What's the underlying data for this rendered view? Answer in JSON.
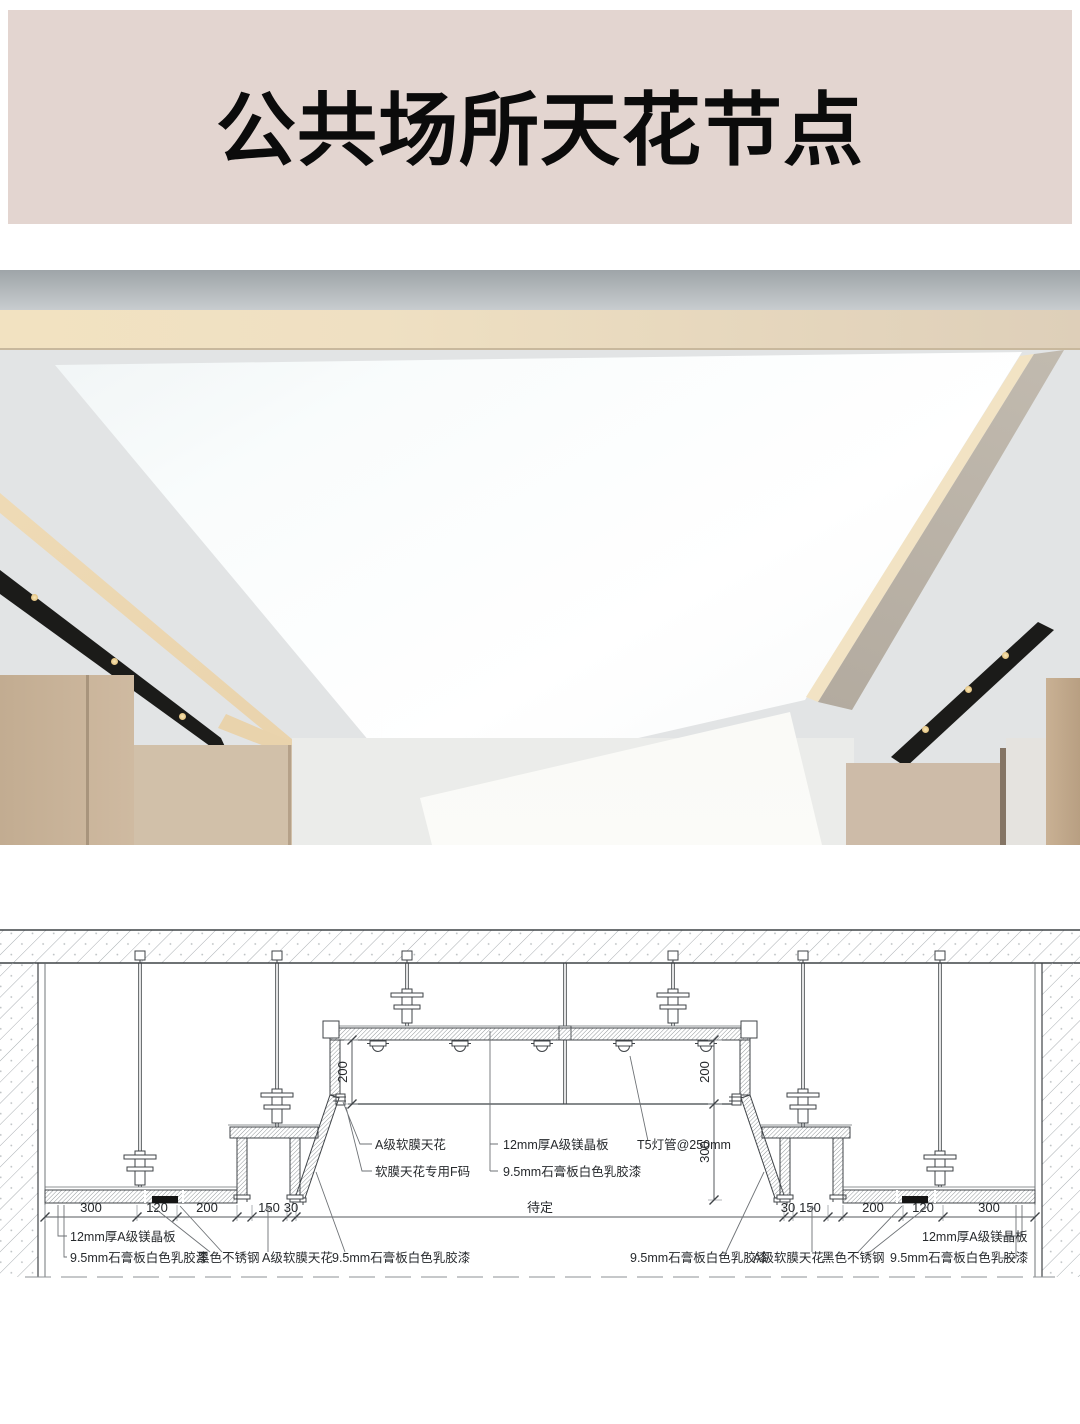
{
  "header": {
    "title": "公共场所天花节点",
    "bg_color": "#E3D5D0",
    "text_color": "#0B0B0B"
  },
  "photo": {
    "description_colors": {
      "fascia_gray": "#B9BEC2",
      "cove_warm_light": "#EFDEBD",
      "ceiling_white": "#E2E4E5",
      "luminous_panel": "#FAFCFC",
      "panel_edge": "#2E3032",
      "black_track": "#1B1B19",
      "track_glow": "#F3DCA8",
      "wood_wall": "#C8B299",
      "beige_wall": "#CDBBA8",
      "white_wall": "#EBECEA"
    }
  },
  "drawing": {
    "ink_color": "#3F4347",
    "dim_color": "#55595C",
    "bottom_dims": {
      "left": [
        "300",
        "120",
        "200",
        "150",
        "30"
      ],
      "center": "待定",
      "right": [
        "30",
        "150",
        "200",
        "120",
        "300"
      ]
    },
    "vertical_dims": {
      "left_200": "200",
      "right_200": "200",
      "right_300": "300"
    },
    "callout_membrane": {
      "line1": "A级软膜天花",
      "line2": "软膜天花专用F码"
    },
    "callout_board": {
      "line1": "12mm厚A级镁晶板",
      "line2": "9.5mm石膏板白色乳胶漆"
    },
    "callout_lamp": {
      "text": "T5灯管@250mm"
    },
    "labels_left": {
      "l1": "12mm厚A级镁晶板",
      "l2": "9.5mm石膏板白色乳胶漆",
      "l3": "黑色不锈钢",
      "l4": "A级软膜天花",
      "l5": "9.5mm石膏板白色乳胶漆"
    },
    "labels_right": {
      "l1": "9.5mm石膏板白色乳胶漆",
      "l2": "A级软膜天花",
      "l3": "黑色不锈钢",
      "l4": "9.5mm石膏板白色乳胶漆",
      "l5": "12mm厚A级镁晶板"
    }
  }
}
